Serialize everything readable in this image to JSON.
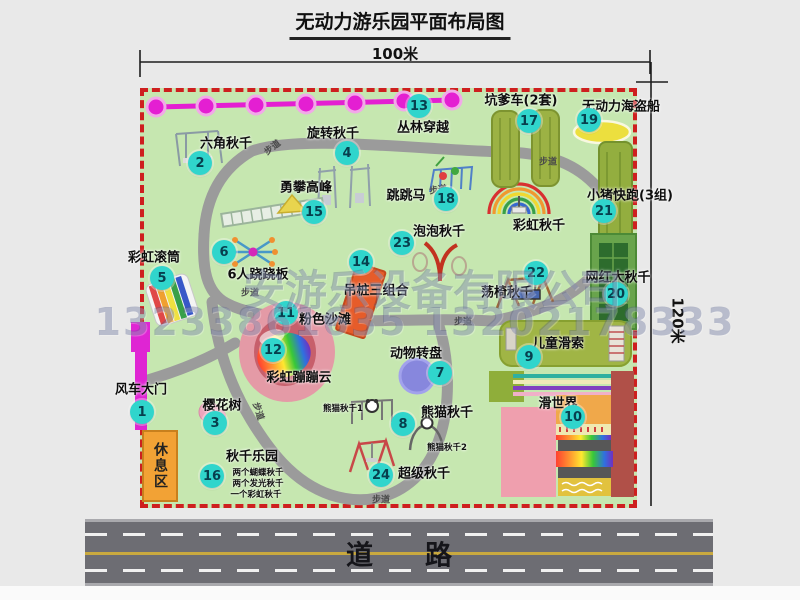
{
  "title": "无动力游乐园平面布局图",
  "dimensions": {
    "width_label": "100米",
    "height_label": "120米"
  },
  "watermark": {
    "line1": "安游乐设备有限公司",
    "line2": "13233861635 13202178333"
  },
  "road": {
    "label": "道路"
  },
  "map": {
    "path_label": "步道",
    "rest_area_label": "休息区",
    "rainbow_swing_label": "彩虹秋千"
  },
  "attractions": [
    {
      "id": "1",
      "label": "风车大门"
    },
    {
      "id": "2",
      "label": "六角秋千"
    },
    {
      "id": "3",
      "label": "樱花树"
    },
    {
      "id": "4",
      "label": "旋转秋千"
    },
    {
      "id": "5",
      "label": "彩虹滚筒"
    },
    {
      "id": "6",
      "label": "6人跷跷板"
    },
    {
      "id": "7",
      "label": "动物转盘"
    },
    {
      "id": "8",
      "label": "熊猫秋千",
      "sub1": "熊猫秋千1",
      "sub2": "熊猫秋千2"
    },
    {
      "id": "9",
      "label": "儿童滑索"
    },
    {
      "id": "10",
      "label": "滑世界"
    },
    {
      "id": "11",
      "label": "粉色沙滩"
    },
    {
      "id": "12",
      "label": "彩虹蹦蹦云"
    },
    {
      "id": "13",
      "label": "丛林穿越"
    },
    {
      "id": "14",
      "label": "吊桩三组合"
    },
    {
      "id": "15",
      "label": "勇攀高峰"
    },
    {
      "id": "16",
      "label": "秋千乐园",
      "sub1": "两个蝴蝶秋千",
      "sub2": "两个发光秋千",
      "sub3": "一个彩虹秋千"
    },
    {
      "id": "17",
      "label": "坑爹车(2套)"
    },
    {
      "id": "18",
      "label": "跳跳马"
    },
    {
      "id": "19",
      "label": "无动力海盗船"
    },
    {
      "id": "20",
      "label": "网红大秋千"
    },
    {
      "id": "21",
      "label": "小猪快跑(3组)"
    },
    {
      "id": "22",
      "label": "荡椅秋千"
    },
    {
      "id": "23",
      "label": "泡泡秋千"
    },
    {
      "id": "24",
      "label": "超级秋千"
    }
  ]
}
